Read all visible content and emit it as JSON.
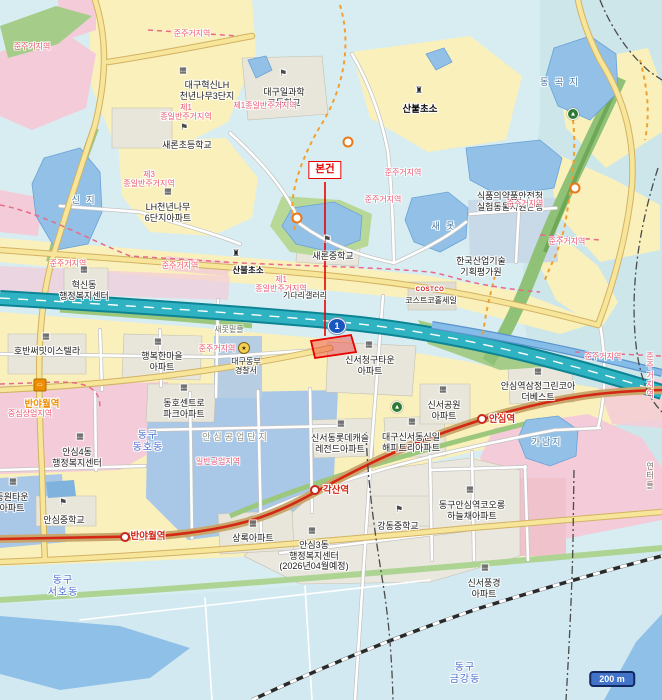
{
  "map": {
    "subject_label": "본건",
    "scale_bar": "200 m",
    "expressway_shield": "1",
    "colors": {
      "subject": "#e80000",
      "expressway": "#2fb3c2",
      "exp-casing": "#0d8494",
      "metro": "#d42814",
      "metro-road": "#c9a66b",
      "zone-text": "#ef5672",
      "district-text": "#4a6fd0",
      "water-text": "#46749e",
      "water": "#92c0e6",
      "residential": "#faf0bb",
      "commercial-pink": "#f4cbd8",
      "industrial-blue": "#a9c7e6",
      "park-green": "#a5cd89",
      "trail-orange": "#f0a030",
      "station-orange": "#ef8e00",
      "scale-badge": "#4273c8",
      "shield-blue": "#1a56c0"
    },
    "labels": [
      {
        "t": "대구혁신LH\n천년나무3단지",
        "x": 207,
        "y": 80,
        "c": "place"
      },
      {
        "t": "대구일과학\n고등학교",
        "x": 284,
        "y": 87,
        "c": "place"
      },
      {
        "t": "새론초등학교",
        "x": 187,
        "y": 140,
        "c": "place"
      },
      {
        "t": "LH천년나무\n6단지아파트",
        "x": 168,
        "y": 202,
        "c": "place"
      },
      {
        "t": "새론중학교",
        "x": 333,
        "y": 251,
        "c": "place"
      },
      {
        "t": "혁신동\n행정복지센터",
        "x": 84,
        "y": 280,
        "c": "place"
      },
      {
        "t": "호반써밋이스텔라",
        "x": 47,
        "y": 346,
        "c": "place"
      },
      {
        "t": "행복한마을\n아파트",
        "x": 162,
        "y": 351,
        "c": "place"
      },
      {
        "t": "동호센트로\n파크아파트",
        "x": 184,
        "y": 398,
        "c": "place"
      },
      {
        "t": "대구동부\n경찰서",
        "x": 246,
        "y": 357,
        "c": "place-sm"
      },
      {
        "t": "신서청구타운\n아파트",
        "x": 370,
        "y": 355,
        "c": "place"
      },
      {
        "t": "기다리갤러리",
        "x": 305,
        "y": 291,
        "c": "place-sm"
      },
      {
        "t": "COSTCO",
        "x": 430,
        "y": 287,
        "c": "costco"
      },
      {
        "t": "코스트코홀세일",
        "x": 431,
        "y": 296,
        "c": "place-sm"
      },
      {
        "t": "한국산업기술\n기획평가원",
        "x": 481,
        "y": 256,
        "c": "place"
      },
      {
        "t": "식품의약품안전청\n실험동물자원은행",
        "x": 510,
        "y": 191,
        "c": "place"
      },
      {
        "t": "신서공원\n아파트",
        "x": 444,
        "y": 400,
        "c": "place"
      },
      {
        "t": "안심역삼정그린코아\n더베스트",
        "x": 538,
        "y": 381,
        "c": "place"
      },
      {
        "t": "신서동롯데캐슬\n레전드아파트",
        "x": 340,
        "y": 433,
        "c": "place"
      },
      {
        "t": "대구신서동신일\n해피트리아파트",
        "x": 411,
        "y": 432,
        "c": "place"
      },
      {
        "t": "상록아파트",
        "x": 253,
        "y": 533,
        "c": "place"
      },
      {
        "t": "강동중학교",
        "x": 398,
        "y": 521,
        "c": "place"
      },
      {
        "t": "안심4동\n행정복지센터",
        "x": 77,
        "y": 447,
        "c": "place"
      },
      {
        "t": "안심중학교",
        "x": 64,
        "y": 515,
        "c": "place"
      },
      {
        "t": "동원타운\n아파트",
        "x": 12,
        "y": 492,
        "c": "place"
      },
      {
        "t": "동구안심역코오롱\n하늘채아파트",
        "x": 472,
        "y": 500,
        "c": "place"
      },
      {
        "t": "신서풍경\n아파트",
        "x": 484,
        "y": 578,
        "c": "place"
      },
      {
        "t": "안심3동\n행정복지센터\n(2026년04월예정)",
        "x": 314,
        "y": 540,
        "c": "place"
      },
      {
        "t": "산불초소",
        "x": 420,
        "y": 104,
        "c": "bold"
      },
      {
        "t": "산불초소",
        "x": 248,
        "y": 265,
        "c": "bold-sm"
      },
      {
        "t": "안심공업단지",
        "x": 236,
        "y": 432,
        "c": "gray"
      },
      {
        "t": "새못밑들",
        "x": 229,
        "y": 325,
        "c": "field"
      },
      {
        "t": "연터들",
        "x": 650,
        "y": 462,
        "c": "field"
      },
      {
        "t": "동 곡 지",
        "x": 560,
        "y": 77,
        "c": "water"
      },
      {
        "t": "신 지",
        "x": 84,
        "y": 195,
        "c": "water"
      },
      {
        "t": "새 못",
        "x": 444,
        "y": 221,
        "c": "water"
      },
      {
        "t": "가남지",
        "x": 547,
        "y": 437,
        "c": "water"
      },
      {
        "t": "동구\n동호동",
        "x": 148,
        "y": 430,
        "c": "district"
      },
      {
        "t": "동구\n서호동",
        "x": 63,
        "y": 575,
        "c": "district"
      },
      {
        "t": "동구\n금강동",
        "x": 465,
        "y": 662,
        "c": "district"
      },
      {
        "t": "준주거지역",
        "x": 32,
        "y": 42,
        "c": "zone"
      },
      {
        "t": "준주거지역",
        "x": 192,
        "y": 29,
        "c": "zone"
      },
      {
        "t": "제1\n종일반주거지역",
        "x": 186,
        "y": 103,
        "c": "zone"
      },
      {
        "t": "제1종일반주거지역",
        "x": 265,
        "y": 101,
        "c": "zone"
      },
      {
        "t": "제3\n종일반주거지역",
        "x": 149,
        "y": 170,
        "c": "zone"
      },
      {
        "t": "준주거지역",
        "x": 403,
        "y": 168,
        "c": "zone"
      },
      {
        "t": "준주거지역",
        "x": 383,
        "y": 195,
        "c": "zone"
      },
      {
        "t": "준주거지역",
        "x": 525,
        "y": 199,
        "c": "zone"
      },
      {
        "t": "준주거지역",
        "x": 567,
        "y": 237,
        "c": "zone"
      },
      {
        "t": "준주거지역",
        "x": 603,
        "y": 352,
        "c": "zone"
      },
      {
        "t": "준주거지역",
        "x": 650,
        "y": 352,
        "c": "zone"
      },
      {
        "t": "준주거지역",
        "x": 68,
        "y": 259,
        "c": "zone"
      },
      {
        "t": "준주거지역",
        "x": 180,
        "y": 261,
        "c": "zone"
      },
      {
        "t": "준주거지역",
        "x": 217,
        "y": 344,
        "c": "zone"
      },
      {
        "t": "제1\n종일반주거지역",
        "x": 281,
        "y": 275,
        "c": "zone"
      },
      {
        "t": "일반공업지역",
        "x": 218,
        "y": 457,
        "c": "zone"
      },
      {
        "t": "중심상업지역",
        "x": 30,
        "y": 409,
        "c": "zone"
      },
      {
        "t": "반야월역",
        "x": 42,
        "y": 399,
        "c": "st-org"
      },
      {
        "t": "반야월역",
        "x": 148,
        "y": 531,
        "c": "st-red"
      },
      {
        "t": "각산역",
        "x": 336,
        "y": 485,
        "c": "st-red"
      },
      {
        "t": "안심역",
        "x": 502,
        "y": 414,
        "c": "st-red"
      }
    ],
    "markers": [
      {
        "type": "building",
        "x": 183,
        "y": 70
      },
      {
        "type": "building",
        "x": 168,
        "y": 191
      },
      {
        "type": "building",
        "x": 84,
        "y": 269
      },
      {
        "type": "building",
        "x": 46,
        "y": 336
      },
      {
        "type": "building",
        "x": 158,
        "y": 341
      },
      {
        "type": "building",
        "x": 184,
        "y": 387
      },
      {
        "type": "building",
        "x": 369,
        "y": 344
      },
      {
        "type": "building",
        "x": 443,
        "y": 389
      },
      {
        "type": "building",
        "x": 538,
        "y": 371
      },
      {
        "type": "building",
        "x": 341,
        "y": 423
      },
      {
        "type": "building",
        "x": 412,
        "y": 421
      },
      {
        "type": "building",
        "x": 253,
        "y": 523
      },
      {
        "type": "building",
        "x": 80,
        "y": 436
      },
      {
        "type": "building",
        "x": 13,
        "y": 481
      },
      {
        "type": "building",
        "x": 470,
        "y": 489
      },
      {
        "type": "building",
        "x": 485,
        "y": 567
      },
      {
        "type": "building",
        "x": 312,
        "y": 530
      },
      {
        "type": "school",
        "x": 283,
        "y": 74
      },
      {
        "type": "school",
        "x": 184,
        "y": 128
      },
      {
        "type": "school",
        "x": 327,
        "y": 240
      },
      {
        "type": "school",
        "x": 399,
        "y": 510
      },
      {
        "type": "school",
        "x": 63,
        "y": 503
      },
      {
        "type": "tower",
        "x": 419,
        "y": 91
      },
      {
        "type": "tower",
        "x": 236,
        "y": 254
      },
      {
        "type": "green",
        "x": 397,
        "y": 407
      },
      {
        "type": "green",
        "x": 573,
        "y": 114
      },
      {
        "type": "ring",
        "x": 348,
        "y": 142
      },
      {
        "type": "ring",
        "x": 297,
        "y": 218
      },
      {
        "type": "ring",
        "x": 575,
        "y": 188
      },
      {
        "type": "station",
        "x": 125,
        "y": 537
      },
      {
        "type": "station",
        "x": 315,
        "y": 490
      },
      {
        "type": "station",
        "x": 482,
        "y": 419
      },
      {
        "type": "bus",
        "x": 40,
        "y": 385
      },
      {
        "type": "police",
        "x": 244,
        "y": 348
      }
    ]
  }
}
